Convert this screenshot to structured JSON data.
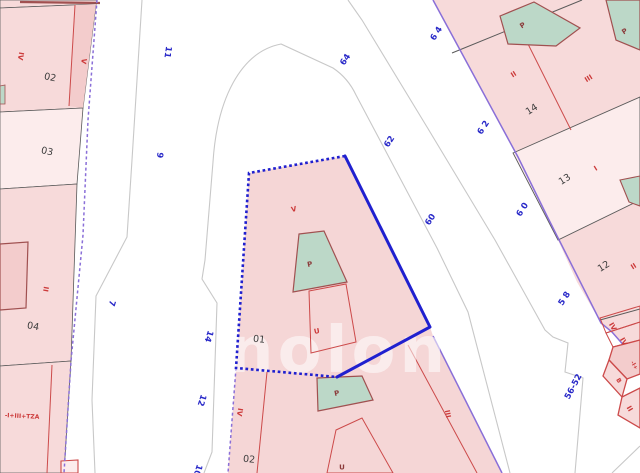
{
  "watermark": "nolon",
  "colors": {
    "background": "#ffffff",
    "parcel_pink": "#f7dada",
    "parcel_pink_light": "#fcecec",
    "parcel_pink_dark": "#f3cccc",
    "parcel_selected": "#f5d6d6",
    "building_green": "#bcd8c8",
    "line_red": "#cc4a4a",
    "line_dark_red": "#a05050",
    "line_black": "#5a5a5a",
    "street_gray": "#c8c8c8",
    "edge_purple": "#8a6fd8",
    "selection_blue": "#2020cf",
    "label_blue": "#2828c8",
    "label_red": "#cc3a3a",
    "label_dark_red": "#8b3a3a",
    "label_black": "#3c3c3c",
    "watermark_color": "#ffffff"
  },
  "labels": {
    "street_numbers": [
      {
        "text": "11",
        "x": 167,
        "y": 52,
        "rot": 98
      },
      {
        "text": "9",
        "x": 159,
        "y": 155,
        "rot": 98
      },
      {
        "text": "7",
        "x": 111,
        "y": 303,
        "rot": 107
      },
      {
        "text": "14",
        "x": 208,
        "y": 336,
        "rot": 108
      },
      {
        "text": "12",
        "x": 201,
        "y": 400,
        "rot": 108
      },
      {
        "text": "10",
        "x": 197,
        "y": 470,
        "rot": 108
      },
      {
        "text": "64",
        "x": 346,
        "y": 60,
        "rot": -57
      },
      {
        "text": "62",
        "x": 390,
        "y": 142,
        "rot": -57
      },
      {
        "text": "60",
        "x": 431,
        "y": 220,
        "rot": -57
      },
      {
        "text": "6 4",
        "x": 437,
        "y": 34,
        "rot": -57
      },
      {
        "text": "6 2",
        "x": 484,
        "y": 128,
        "rot": -57
      },
      {
        "text": "6 0",
        "x": 523,
        "y": 210,
        "rot": -57
      },
      {
        "text": "5 8",
        "x": 565,
        "y": 299,
        "rot": -57
      },
      {
        "text": "56-52",
        "x": 574,
        "y": 387,
        "rot": -62
      }
    ],
    "parcel_numbers": [
      {
        "text": "02",
        "x": 50,
        "y": 78,
        "rot": 12
      },
      {
        "text": "03",
        "x": 47,
        "y": 152,
        "rot": 12
      },
      {
        "text": "04",
        "x": 33,
        "y": 327,
        "rot": 10
      },
      {
        "text": "01",
        "x": 259,
        "y": 340,
        "rot": 6
      },
      {
        "text": "02",
        "x": 249,
        "y": 460,
        "rot": 6
      },
      {
        "text": "14",
        "x": 532,
        "y": 110,
        "rot": -32
      },
      {
        "text": "13",
        "x": 565,
        "y": 180,
        "rot": -32
      },
      {
        "text": "12",
        "x": 604,
        "y": 267,
        "rot": -32
      }
    ],
    "floor_codes": [
      {
        "text": "IV",
        "x": 20,
        "y": 56,
        "rot": 100
      },
      {
        "text": "V",
        "x": 83,
        "y": 61,
        "rot": 100
      },
      {
        "text": "II",
        "x": 45,
        "y": 289,
        "rot": 100
      },
      {
        "text": "-I+III+TZA",
        "x": 22,
        "y": 417,
        "rot": 3,
        "size": 6
      },
      {
        "text": "V",
        "x": 294,
        "y": 210,
        "rot": -12
      },
      {
        "text": "U",
        "x": 317,
        "y": 332,
        "rot": -12
      },
      {
        "text": "IV",
        "x": 239,
        "y": 412,
        "rot": 100
      },
      {
        "text": "III",
        "x": 447,
        "y": 414,
        "rot": 78
      },
      {
        "text": "II",
        "x": 514,
        "y": 75,
        "rot": -32
      },
      {
        "text": "III",
        "x": 589,
        "y": 79,
        "rot": -32
      },
      {
        "text": "I",
        "x": 596,
        "y": 169,
        "rot": -32
      },
      {
        "text": "II",
        "x": 634,
        "y": 267,
        "rot": -32
      },
      {
        "text": "IV",
        "x": 612,
        "y": 327,
        "rot": 60
      },
      {
        "text": "IV",
        "x": 623,
        "y": 342,
        "rot": 60
      },
      {
        "text": "-I+",
        "x": 633,
        "y": 366,
        "rot": 60,
        "size": 5.5
      },
      {
        "text": "B",
        "x": 618,
        "y": 381,
        "rot": 60,
        "size": 6
      },
      {
        "text": "II",
        "x": 629,
        "y": 409,
        "rot": 60
      }
    ],
    "building_codes": [
      {
        "text": "P",
        "x": 310,
        "y": 265,
        "rot": -12
      },
      {
        "text": "P",
        "x": 337,
        "y": 394,
        "rot": -12
      },
      {
        "text": "P",
        "x": 523,
        "y": 26,
        "rot": -32
      },
      {
        "text": "P",
        "x": 625,
        "y": 32,
        "rot": -32
      },
      {
        "text": "U",
        "x": 342,
        "y": 468,
        "rot": 0
      }
    ]
  }
}
